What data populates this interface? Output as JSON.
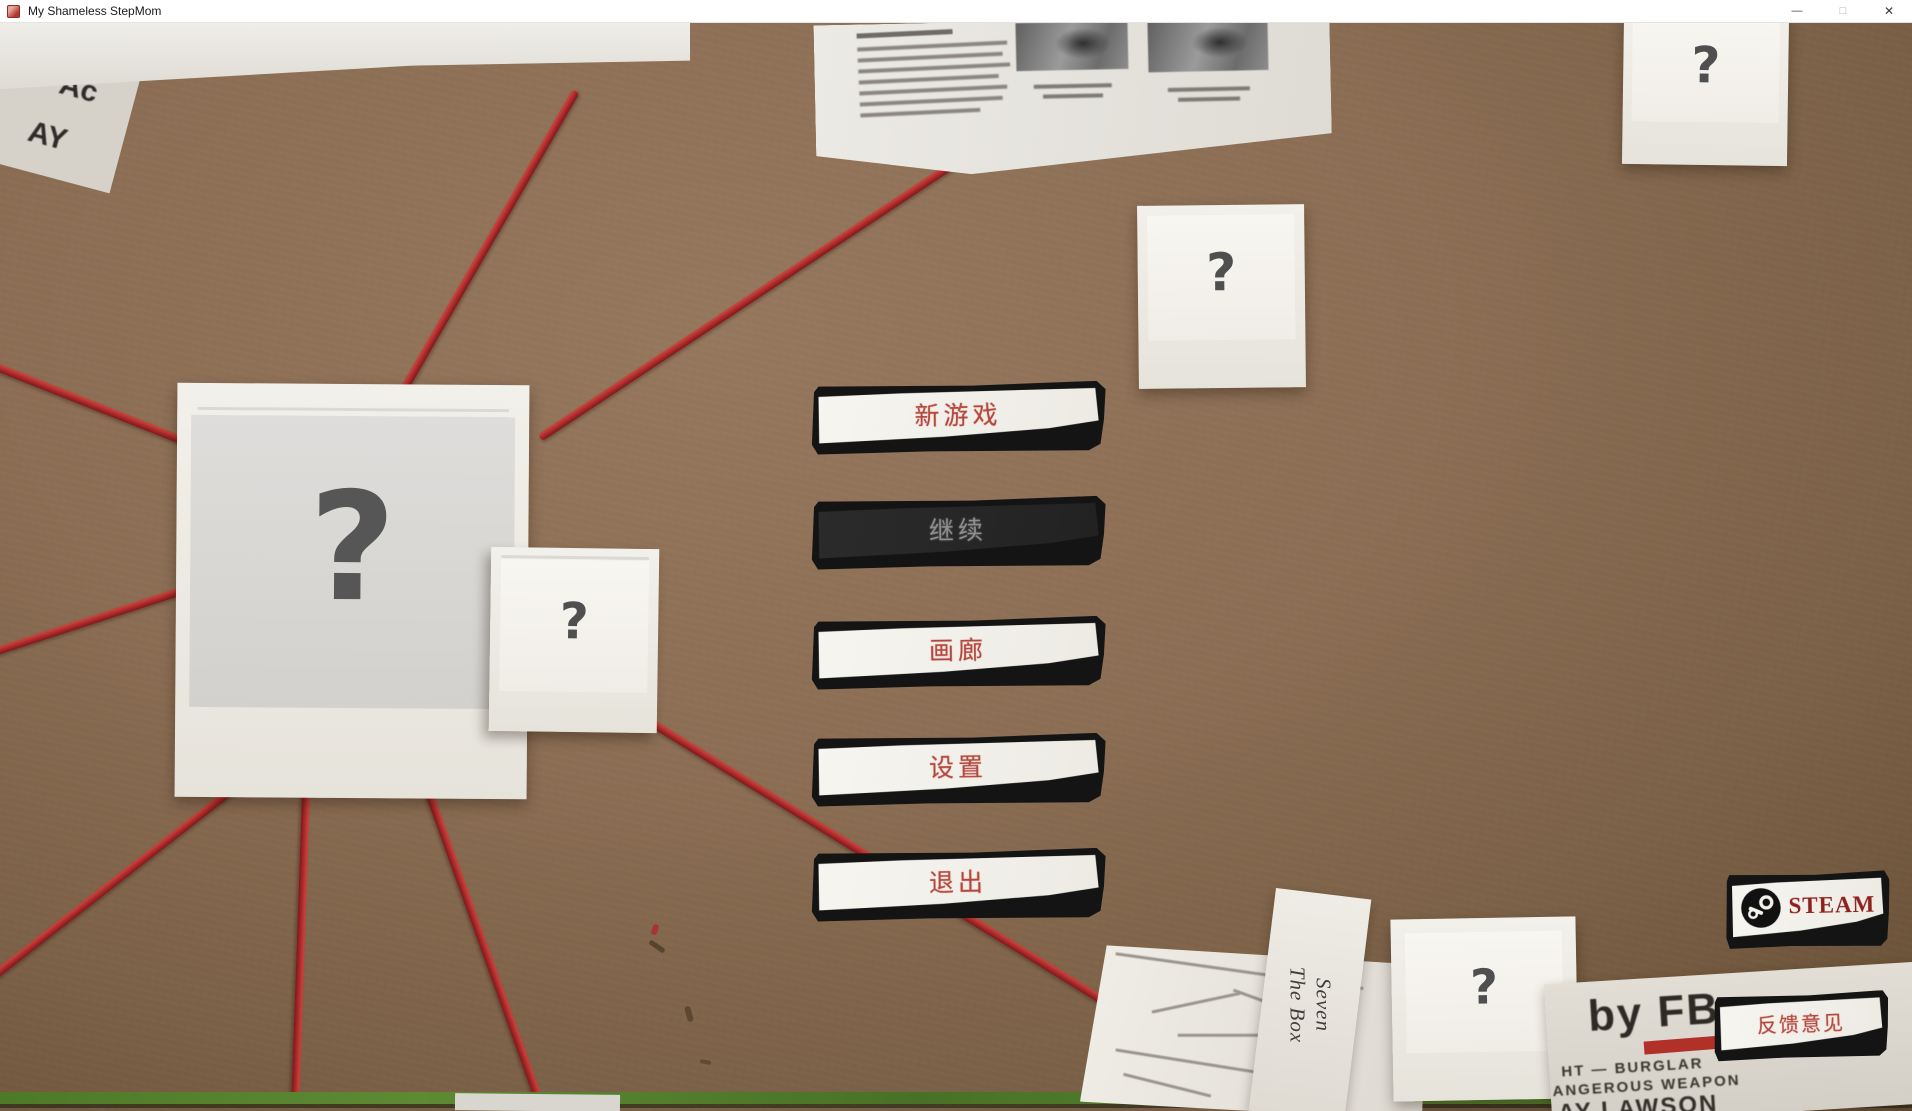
{
  "window": {
    "title": "My Shameless StepMom",
    "controls": {
      "minimize": "—",
      "maximize": "□",
      "close": "✕"
    }
  },
  "menu": {
    "buttons": [
      {
        "label": "新游戏",
        "state": "enabled"
      },
      {
        "label": "继续",
        "state": "disabled"
      },
      {
        "label": "画廊",
        "state": "enabled"
      },
      {
        "label": "设置",
        "state": "enabled"
      },
      {
        "label": "退出",
        "state": "enabled"
      }
    ]
  },
  "links": {
    "steam": {
      "label": "STEAM",
      "icon": "steam-logo-icon"
    },
    "feedback": {
      "label": "反馈意见"
    }
  },
  "board": {
    "polaroids": [
      {
        "label": "?"
      },
      {
        "label": "?"
      },
      {
        "label": "?"
      },
      {
        "label": "?"
      },
      {
        "label": "?"
      }
    ],
    "note": {
      "line1": "Seven",
      "line2": "The Box"
    },
    "bottom_newspaper": {
      "headline": "by FB",
      "lines": [
        "HT — BURGLAR",
        "ANGEROUS WEAPON",
        "AY LAWSON"
      ]
    },
    "fragment_letters": [
      "1b",
      "Ac",
      "AY"
    ]
  },
  "colors": {
    "board_brown": "#8b6e54",
    "string_red": "#b02a2a",
    "button_text_red": "#b5463c",
    "steam_text_red": "#8e211d",
    "continue_bg": "#262626",
    "disabled_text": "#909090",
    "green_strip": "#54802c"
  }
}
